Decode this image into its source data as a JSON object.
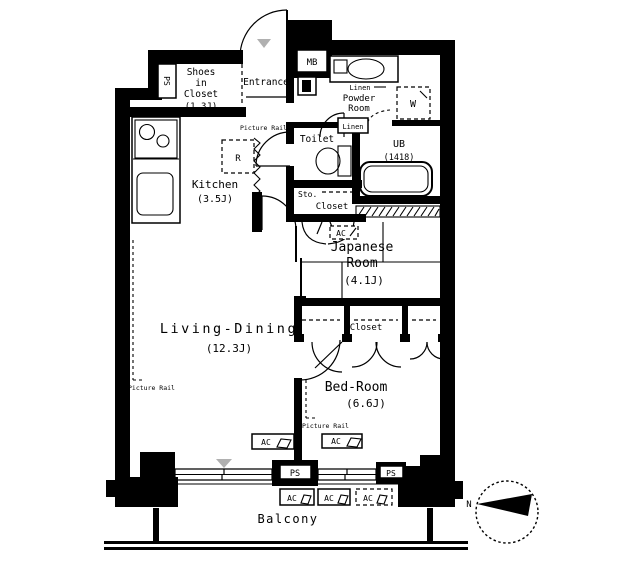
{
  "rooms": {
    "shoes_closet_1": "Shoes",
    "shoes_closet_2": "in",
    "shoes_closet_3": "Closet",
    "shoes_closet_size": "(1.3J)",
    "entrance": "Entrance",
    "kitchen": "Kitchen",
    "kitchen_size": "(3.5J)",
    "powder_1": "Powder",
    "powder_2": "Room",
    "toilet": "Toilet",
    "ub": "UB",
    "ub_size": "(1418)",
    "japanese_1": "Japanese",
    "japanese_2": "Room",
    "japanese_size": "(4.1J)",
    "living": "Living-Dining",
    "living_size": "(12.3J)",
    "bedroom": "Bed-Room",
    "bedroom_size": "(6.6J)",
    "balcony": "Balcony"
  },
  "labels": {
    "mb": "MB",
    "ps": "PS",
    "w": "W",
    "r": "R",
    "ac": "AC",
    "linen": "Linen",
    "sto": "Sto.",
    "closet": "Closet",
    "picture_rail": "Picture Rail",
    "north": "N"
  },
  "colors": {
    "wall": "#000000",
    "background": "#ffffff",
    "marker_gray": "#b0b0b0"
  }
}
